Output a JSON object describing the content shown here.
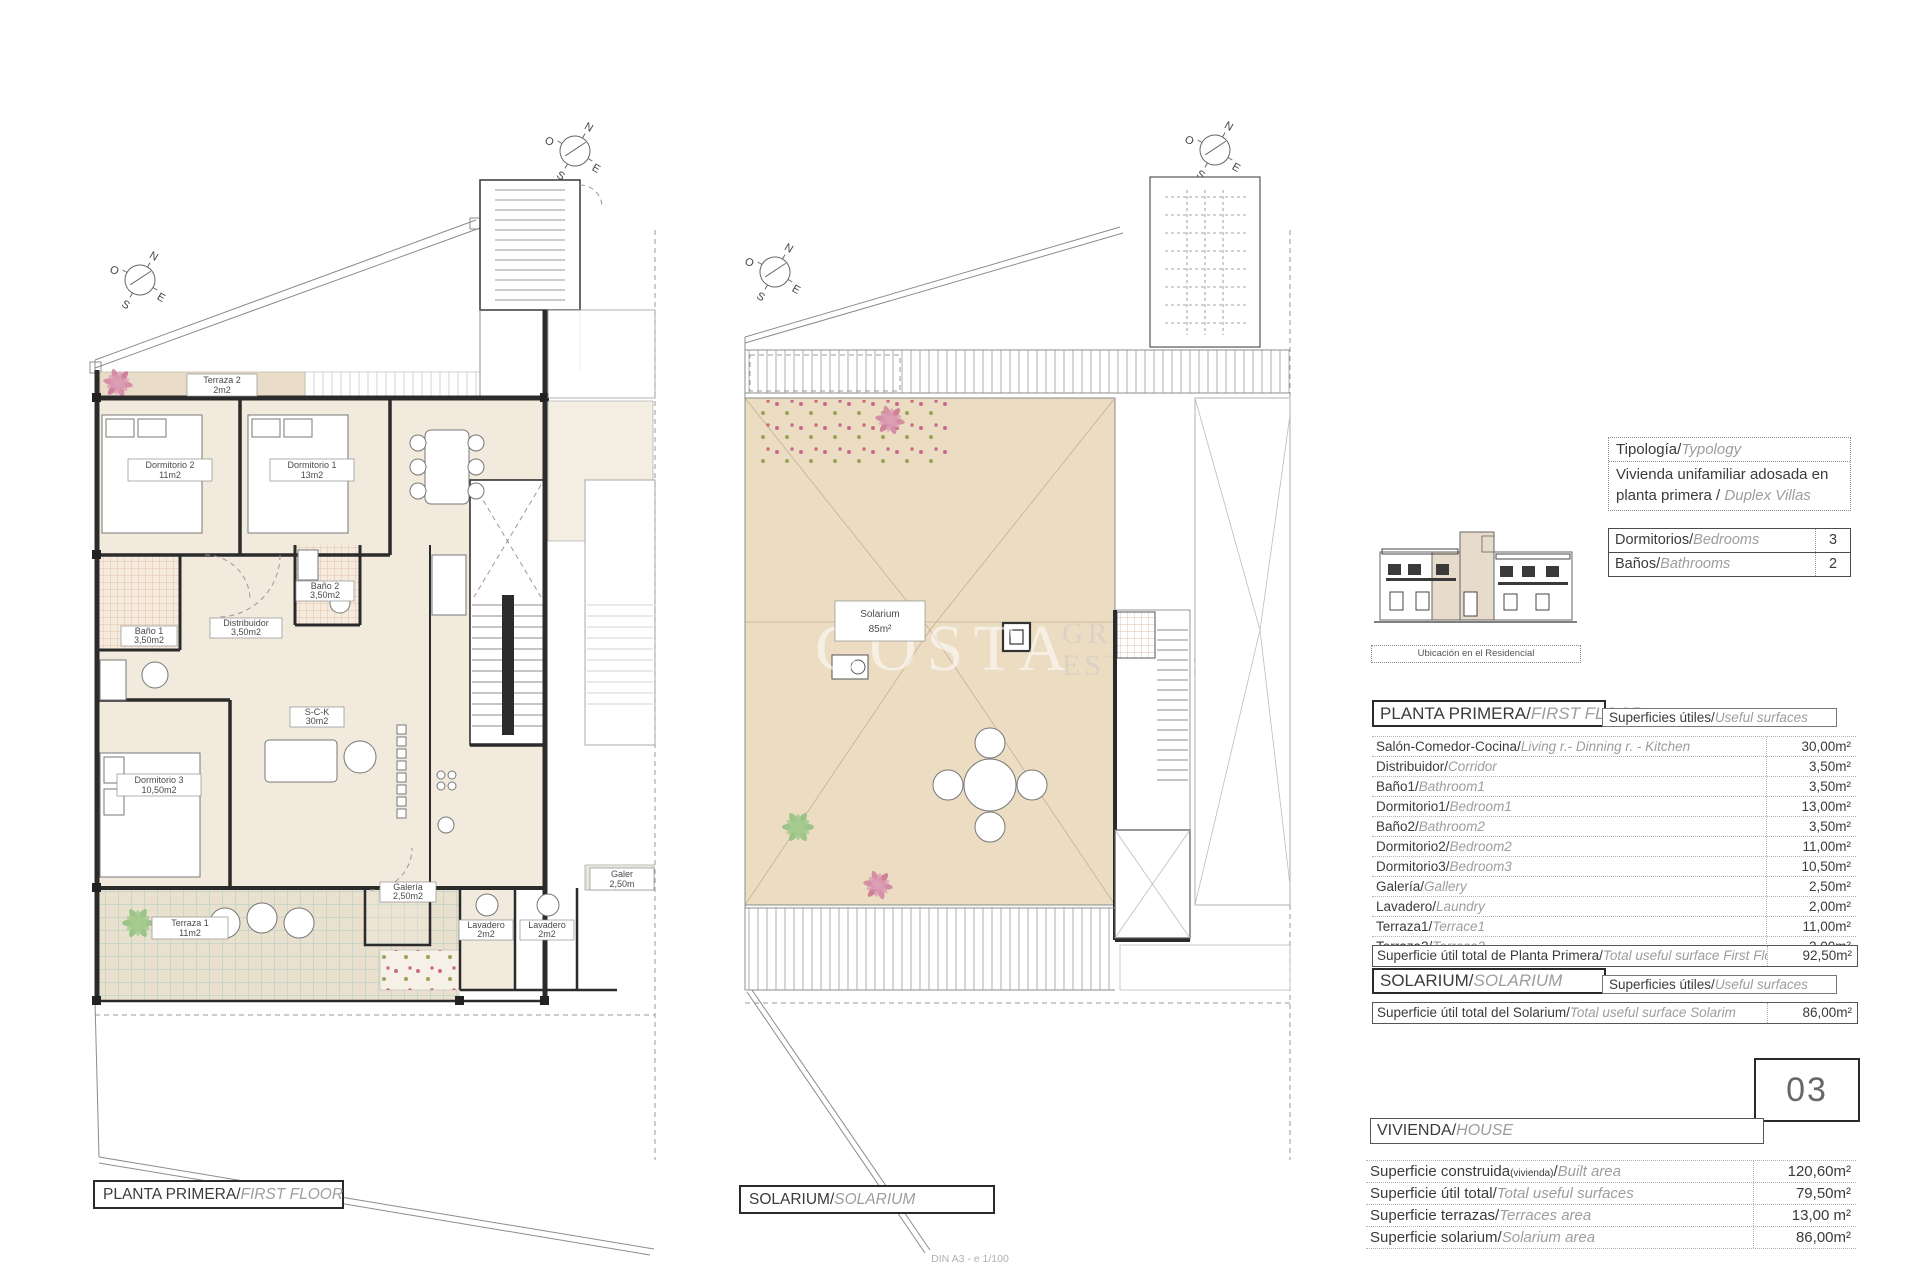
{
  "colors": {
    "plan_cream": "#f1eadd",
    "solarium_beige": "#ebdcc2",
    "terrace_teal": "#a9cdc5",
    "bath_hatch": "#dcc0ab",
    "wall": "#2b2b2b",
    "dark_text": "#3b3b3b",
    "muted_text": "#9d9d9d"
  },
  "compass": {
    "n": "N",
    "e": "E",
    "s": "S",
    "o": "O"
  },
  "watermark": {
    "line1": "COSTA",
    "line2": "GROUP",
    "line3": "ESTATES"
  },
  "scale_note": "DIN A3 - e 1/100",
  "plan_first_floor": {
    "caption_es": "PLANTA PRIMERA/",
    "caption_en": "FIRST FLOOR",
    "rooms": [
      {
        "name": "Terraza 2",
        "area": "2m2"
      },
      {
        "name": "Dormitorio 2",
        "area": "11m2"
      },
      {
        "name": "Dormitorio 1",
        "area": "13m2"
      },
      {
        "name": "Baño 1",
        "area": "3,50m2"
      },
      {
        "name": "Baño 2",
        "area": "3,50m2"
      },
      {
        "name": "Distribuidor",
        "area": "3,50m2"
      },
      {
        "name": "S-C-K",
        "area": "30m2"
      },
      {
        "name": "Dormitorio 3",
        "area": "10,50m2"
      },
      {
        "name": "Terraza 1",
        "area": "11m2"
      },
      {
        "name": "Galería",
        "area": "2,50m2"
      },
      {
        "name": "Lavadero",
        "area": "2m2"
      },
      {
        "name": "Lavadero",
        "area": "2m2"
      },
      {
        "name": "Galer",
        "area": "2,50m"
      }
    ]
  },
  "plan_solarium": {
    "caption_es": "SOLARIUM/",
    "caption_en": "SOLARIUM",
    "room": {
      "name": "Solarium",
      "area": "85m²"
    }
  },
  "info": {
    "typology": {
      "label_es": "Tipología/",
      "label_en": "Typology",
      "value_es": "Vivienda unifamiliar adosada en planta primera / ",
      "value_en": "Duplex Villas"
    },
    "counts": [
      {
        "es": "Dormitorios/",
        "en": "Bedrooms",
        "value": "3"
      },
      {
        "es": "Baños/",
        "en": "Bathrooms",
        "value": "2"
      }
    ],
    "location_label": "Ubicación en el Residencial",
    "first_floor": {
      "header_es": "PLANTA PRIMERA/",
      "header_en": "FIRST FLOOR",
      "surfaces_es": "Superficies útiles/",
      "surfaces_en": "Useful surfaces",
      "rows": [
        {
          "es": "Salón-Comedor-Cocina/",
          "en": "Living r.- Dinning r. - Kitchen",
          "value": "30,00m²"
        },
        {
          "es": "Distribuidor/",
          "en": "Corridor",
          "value": "3,50m²"
        },
        {
          "es": "Baño1/",
          "en": "Bathroom1",
          "value": "3,50m²"
        },
        {
          "es": "Dormitorio1/",
          "en": "Bedroom1",
          "value": "13,00m²"
        },
        {
          "es": "Baño2/",
          "en": "Bathroom2",
          "value": "3,50m²"
        },
        {
          "es": "Dormitorio2/",
          "en": "Bedroom2",
          "value": "11,00m²"
        },
        {
          "es": "Dormitorio3/",
          "en": "Bedroom3",
          "value": "10,50m²"
        },
        {
          "es": "Galería/",
          "en": "Gallery",
          "value": "2,50m²"
        },
        {
          "es": "Lavadero/",
          "en": "Laundry",
          "value": "2,00m²"
        },
        {
          "es": "Terraza1/",
          "en": "Terrace1",
          "value": "11,00m²"
        },
        {
          "es": "Terraza2/",
          "en": "Terrace2",
          "value": "2,00m²"
        }
      ],
      "total": {
        "es": "Superficie útil total de Planta Primera/",
        "en": "Total useful surface First Floor",
        "value": "92,50m²"
      }
    },
    "solarium": {
      "header_es": "SOLARIUM/",
      "header_en": "SOLARIUM",
      "surfaces_es": "Superficies útiles/",
      "surfaces_en": "Useful surfaces",
      "total": {
        "es": "Superficie útil total del Solarium/",
        "en": "Total useful surface Solarim",
        "value": "86,00m²"
      }
    },
    "unit_number": "03",
    "house": {
      "header_es": "VIVIENDA/",
      "header_en": "HOUSE",
      "rows": [
        {
          "es": "Superficie construida",
          "small": "(vivienda)",
          "sep": "/",
          "en": "Built area",
          "value": "120,60m²"
        },
        {
          "es": "Superficie útil total/",
          "small": "",
          "sep": "",
          "en": "Total useful surfaces",
          "value": "79,50m²"
        },
        {
          "es": "Superficie terrazas/",
          "small": "",
          "sep": "",
          "en": "Terraces area",
          "value": "13,00 m²"
        },
        {
          "es": "Superficie solarium/",
          "small": "",
          "sep": "",
          "en": "Solarium area",
          "value": "86,00m²"
        }
      ]
    }
  }
}
